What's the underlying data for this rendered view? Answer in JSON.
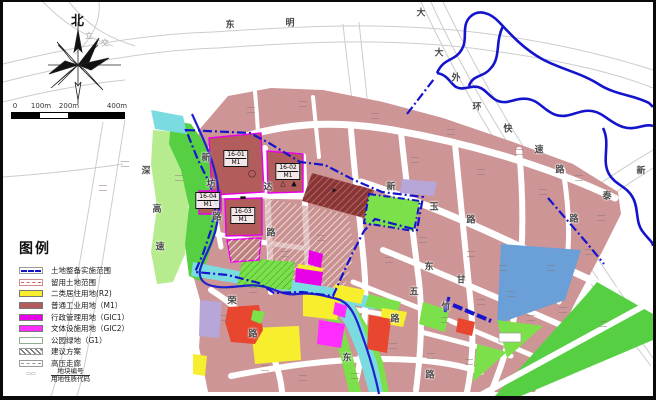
{
  "colors": {
    "blob": "#cd9595",
    "block_dark": "#b25c5c",
    "hatch_dark": "#8a3535",
    "yellow": "#f7ef2e",
    "magenta": "#e800e8",
    "magenta2": "#ff2dff",
    "green": "#57cf43",
    "green_bright": "#7ce04a",
    "green_light": "#b6ec8e",
    "cyan": "#7adce0",
    "water": "#6a9fd8",
    "lavender": "#b7a6d8",
    "red": "#e8462e",
    "boundary": "#1414cc",
    "river": "#2020cc",
    "road_faint": "#cccccc",
    "white": "#ffffff"
  },
  "compass": {
    "north_label": "北"
  },
  "scale_bar": {
    "ticks": [
      "0",
      "100m",
      "200m",
      "400m"
    ]
  },
  "legend": {
    "title": "图例",
    "items": [
      {
        "label": "土地整备实施范围",
        "swatch": "boundary-line"
      },
      {
        "label": "留用土地范围",
        "swatch": "reserved-box"
      },
      {
        "label": "二类居住用地(R2)",
        "swatch": "fill",
        "color": "#f7ef2e"
      },
      {
        "label": "普通工业用地（M1）",
        "swatch": "fill",
        "color": "#b25c5c"
      },
      {
        "label": "行政管理用地（GIC1）",
        "swatch": "fill",
        "color": "#e800e8"
      },
      {
        "label": "文体设施用地（GIC2）",
        "swatch": "fill",
        "color": "#ff2dff"
      },
      {
        "label": "公园绿地（G1）",
        "swatch": "outline-box"
      },
      {
        "label": "建议方案",
        "swatch": "hatch"
      },
      {
        "label": "高压走廊",
        "swatch": "corridor-box"
      },
      {
        "label": "地块编号／用地性质代码",
        "swatch": "plot-code",
        "label_top": "地块编号",
        "label_bottom": "用地性质代码"
      }
    ]
  },
  "map": {
    "plots": [
      {
        "id": "16-01",
        "code": "M1",
        "x": 233,
        "y": 148
      },
      {
        "id": "16-02",
        "code": "M1",
        "x": 285,
        "y": 161
      },
      {
        "id": "16-03",
        "code": "M1",
        "x": 240,
        "y": 205
      },
      {
        "id": "16-04",
        "code": "M1",
        "x": 205,
        "y": 190
      }
    ],
    "plot_symbols": [
      {
        "glyph": "◯",
        "x": 249,
        "y": 172
      },
      {
        "glyph": "▬",
        "x": 240,
        "y": 196
      },
      {
        "glyph": "△",
        "x": 280,
        "y": 182
      },
      {
        "glyph": "▲",
        "x": 291,
        "y": 182
      },
      {
        "glyph": "➤",
        "x": 331,
        "y": 189
      }
    ],
    "road_labels": [
      {
        "t": "东",
        "x": 227,
        "y": 22
      },
      {
        "t": "明",
        "x": 287,
        "y": 20
      },
      {
        "t": "大",
        "x": 418,
        "y": 10
      },
      {
        "t": "大",
        "x": 436,
        "y": 50
      },
      {
        "t": "外",
        "x": 453,
        "y": 75
      },
      {
        "t": "环",
        "x": 474,
        "y": 104
      },
      {
        "t": "快",
        "x": 505,
        "y": 126
      },
      {
        "t": "速",
        "x": 536,
        "y": 147
      },
      {
        "t": "路",
        "x": 557,
        "y": 167
      },
      {
        "t": "新",
        "x": 638,
        "y": 168
      },
      {
        "t": "泰",
        "x": 604,
        "y": 193
      },
      {
        "t": "路",
        "x": 571,
        "y": 216
      },
      {
        "t": "深",
        "x": 143,
        "y": 168
      },
      {
        "t": "高",
        "x": 154,
        "y": 206
      },
      {
        "t": "速",
        "x": 157,
        "y": 244
      },
      {
        "t": "新",
        "x": 203,
        "y": 155
      },
      {
        "t": "坊",
        "x": 208,
        "y": 181
      },
      {
        "t": "路",
        "x": 214,
        "y": 214
      },
      {
        "t": "达",
        "x": 265,
        "y": 184
      },
      {
        "t": "路",
        "x": 268,
        "y": 230
      },
      {
        "t": "新",
        "x": 388,
        "y": 184
      },
      {
        "t": "玉",
        "x": 431,
        "y": 204
      },
      {
        "t": "路",
        "x": 468,
        "y": 217
      },
      {
        "t": "东",
        "x": 426,
        "y": 264
      },
      {
        "t": "甘",
        "x": 458,
        "y": 277
      },
      {
        "t": "五",
        "x": 411,
        "y": 289
      },
      {
        "t": "竹",
        "x": 443,
        "y": 304
      },
      {
        "t": "荣",
        "x": 229,
        "y": 298
      },
      {
        "t": "路",
        "x": 250,
        "y": 331
      },
      {
        "t": "东",
        "x": 344,
        "y": 355
      },
      {
        "t": "路",
        "x": 392,
        "y": 316
      },
      {
        "t": "路",
        "x": 427,
        "y": 372
      },
      {
        "t": "立",
        "x": 86,
        "y": 34,
        "faint": true
      },
      {
        "t": "交",
        "x": 102,
        "y": 41,
        "faint": true
      }
    ],
    "faint_marks": [
      [
        248,
        108
      ],
      [
        300,
        102
      ],
      [
        372,
        114
      ],
      [
        448,
        130
      ],
      [
        516,
        150
      ],
      [
        576,
        176
      ],
      [
        412,
        158
      ],
      [
        478,
        170
      ],
      [
        540,
        190
      ],
      [
        598,
        216
      ],
      [
        420,
        238
      ],
      [
        468,
        252
      ],
      [
        500,
        266
      ],
      [
        548,
        266
      ],
      [
        586,
        250
      ],
      [
        442,
        318
      ],
      [
        478,
        300
      ],
      [
        508,
        292
      ],
      [
        528,
        316
      ],
      [
        560,
        308
      ],
      [
        386,
        258
      ],
      [
        318,
        236
      ],
      [
        282,
        252
      ],
      [
        250,
        288
      ],
      [
        222,
        316
      ],
      [
        262,
        366
      ],
      [
        300,
        376
      ],
      [
        352,
        374
      ],
      [
        390,
        344
      ],
      [
        428,
        354
      ],
      [
        466,
        360
      ],
      [
        600,
        322
      ],
      [
        100,
        186
      ],
      [
        122,
        162
      ],
      [
        176,
        176
      ]
    ]
  }
}
